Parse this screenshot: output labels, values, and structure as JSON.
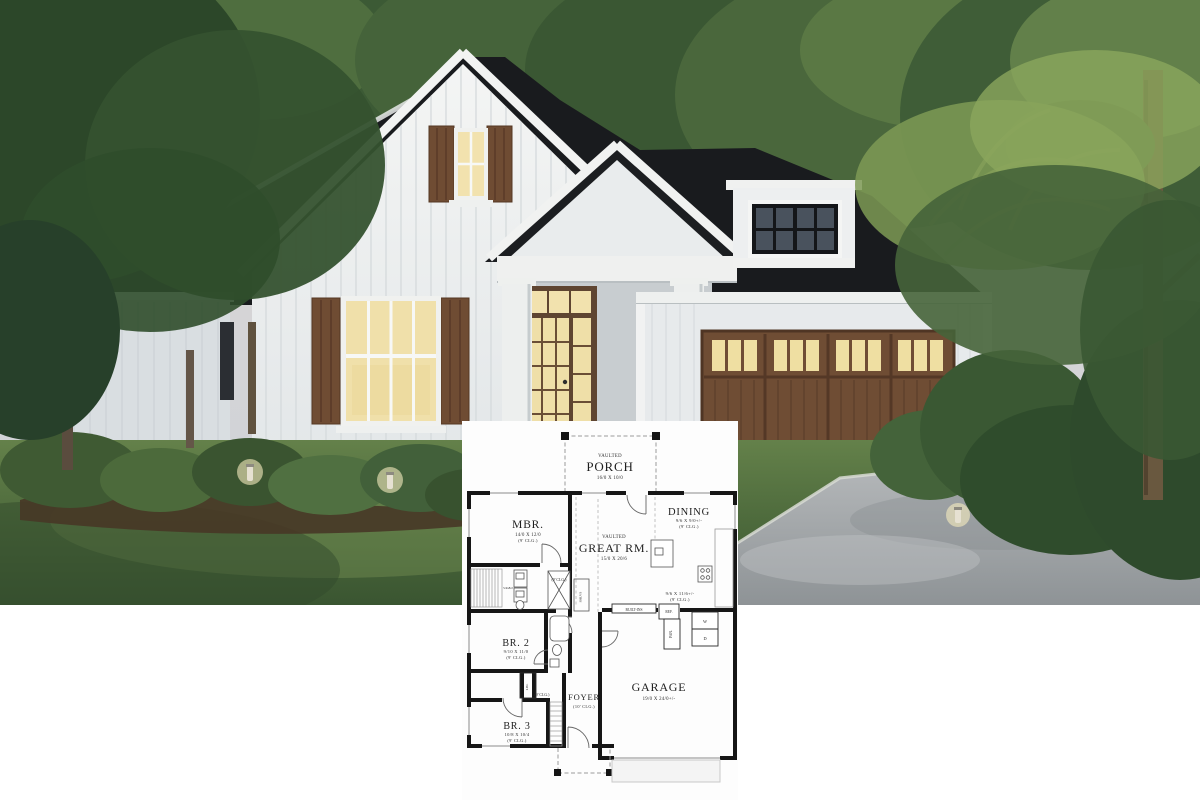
{
  "photo": {
    "alt": "Modern farmhouse exterior rendering at dusk: white board-and-batten siding, dark charcoal roof, wood shutters, lit windows, wood double garage door, lawn, shrubs, path lights, trees and driveway",
    "colors": {
      "sky_top": "#dcd7d3",
      "sky_bottom": "#cdd1d8",
      "roof": "#1a1c1f",
      "siding": "#eff1f1",
      "siding_shadow": "#d9dee1",
      "wood_trim": "#6f4c33",
      "window_glow": "#f2e2ae",
      "dormer_glass": "#49525d",
      "grass": "#54713f",
      "driveway": "#aaaeb0",
      "foliage": "#3d5c38"
    }
  },
  "floor_plan": {
    "porch": {
      "prefix": "VAULTED",
      "name": "PORCH",
      "dims": "16/0 X 10/0"
    },
    "great_rm": {
      "prefix": "VAULTED",
      "name": "GREAT RM.",
      "dims": "15/0 X 20/6"
    },
    "mbr": {
      "name": "MBR.",
      "dims": "14/0 X 12/0",
      "clg": "(9' CLG.)"
    },
    "dining": {
      "name": "DINING",
      "dims": "9/6 X 9/0+/-",
      "clg": "(9' CLG.)"
    },
    "kitchen": {
      "dims": "9/6 X 11/6+/-",
      "clg": "(9' CLG.)"
    },
    "br2": {
      "name": "BR. 2",
      "dims": "9/10 X 11/0",
      "clg": "(9' CLG.)"
    },
    "br3": {
      "name": "BR. 3",
      "dims": "10/8 X 10/4",
      "clg": "(9' CLG.)"
    },
    "foyer": {
      "name": "FOYER",
      "clg": "(10' CLG.)"
    },
    "garage": {
      "name": "GARAGE",
      "dims": "19/0 X 24/0+/-"
    },
    "mbath": {
      "clg": "(9' CLG.)",
      "closet_dims": "5/4x8/2",
      "shelves": "SHLVS"
    },
    "hall": {
      "clg": "(9' CLG.)",
      "linen": "LIN."
    },
    "utility": {
      "built_ins": "BUILT-INS",
      "ref": "REF.",
      "pantry": "PAN.",
      "washer": "W",
      "dryer": "D"
    }
  }
}
